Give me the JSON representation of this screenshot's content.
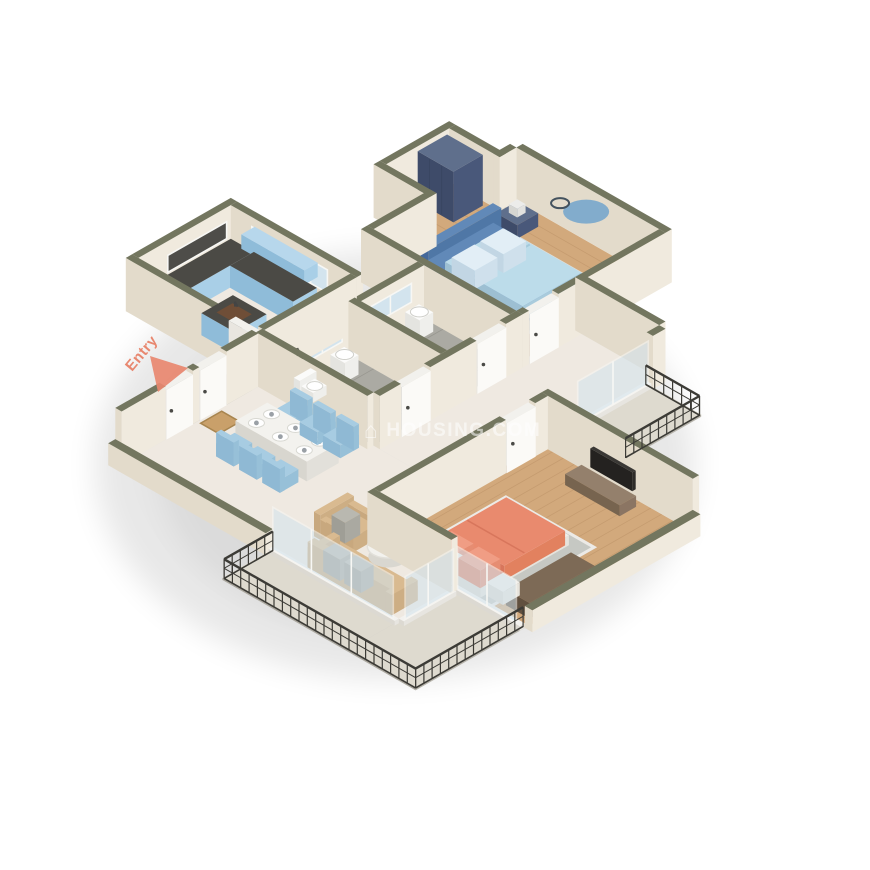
{
  "watermark": {
    "icon_glyph": "⌂",
    "icon_name": "house-icon",
    "text": "HOUSING.COM"
  },
  "entry": {
    "label": "Entry",
    "arrow_icon": "entry-direction-arrow-icon"
  },
  "rooms": [
    "entry",
    "dining-area",
    "living-room",
    "kitchen",
    "bathroom-1",
    "bathroom-2",
    "lobby",
    "master-bedroom",
    "second-bedroom",
    "balcony-right",
    "balcony-bottom",
    "entry-landing"
  ],
  "furnishings": [
    "navy-wardrobe",
    "blue-double-bed",
    "nightstands-with-lamps",
    "round-wall-decor",
    "coral-double-bed",
    "tv-unit",
    "storage-chest",
    "dining-table-6-blue-chairs",
    "tan-sofa",
    "tan-armchair",
    "round-coffee-table",
    "kitchen-l-counter",
    "kitchen-island",
    "dishwasher",
    "toilets",
    "washbasins",
    "showers",
    "doormat",
    "area-rugs",
    "iron-railings"
  ],
  "colors": {
    "wall_cap": "#73765f",
    "wall_face": "#f0eade",
    "wall_face_shade": "#e3dbcb",
    "wood": "#d2a97c",
    "wood_line": "#bb9166",
    "tile": "#abaaa3",
    "tile_line": "#96958e",
    "marble": "#efe9e1",
    "balcony_floor": "#dedacf",
    "landing": "#b7b4aa",
    "cabinet_blue": "#a9cfe7",
    "cabinet_blue_shade": "#8fbcd9",
    "counter_dark": "#4b4a45",
    "wardrobe_top": "#5f6f8c",
    "wardrobe_face": "#49587a",
    "wardrobe_shade": "#3e4b69",
    "bed_blue": "#6189b8",
    "bed_blue_shade": "#4f77a6",
    "bed_blue_dark": "#44689a",
    "bedding": "#bcdcea",
    "pillow_light": "#e2eef6",
    "rug_gray": "#b3b6b1",
    "rug_border": "#dededa",
    "coral": "#e98a6e",
    "coral_shade": "#e2815f",
    "coral_dark": "#d8765c",
    "sofa_tan": "#d9ba90",
    "sofa_tan_dark": "#c8a87e",
    "pillow_gray": "#b9b8b0",
    "table_white": "#f3f2ee",
    "table_side": "#e2e0da",
    "chair_blue": "#a7cce2",
    "chair_blue_shade": "#8fb9d4",
    "chest_brown": "#6f5d4b",
    "console_brown": "#8b7563",
    "tv_dark": "#2e2c29",
    "railing": "#3c3b36",
    "glass": "#d3e4ee",
    "door_white": "#fbfaf7",
    "door_shade": "#e9e6e0",
    "doormat": "#c9a06a",
    "entry_accent": "#e8876f",
    "watermark_text": "#ffffff",
    "background": "#ffffff"
  }
}
